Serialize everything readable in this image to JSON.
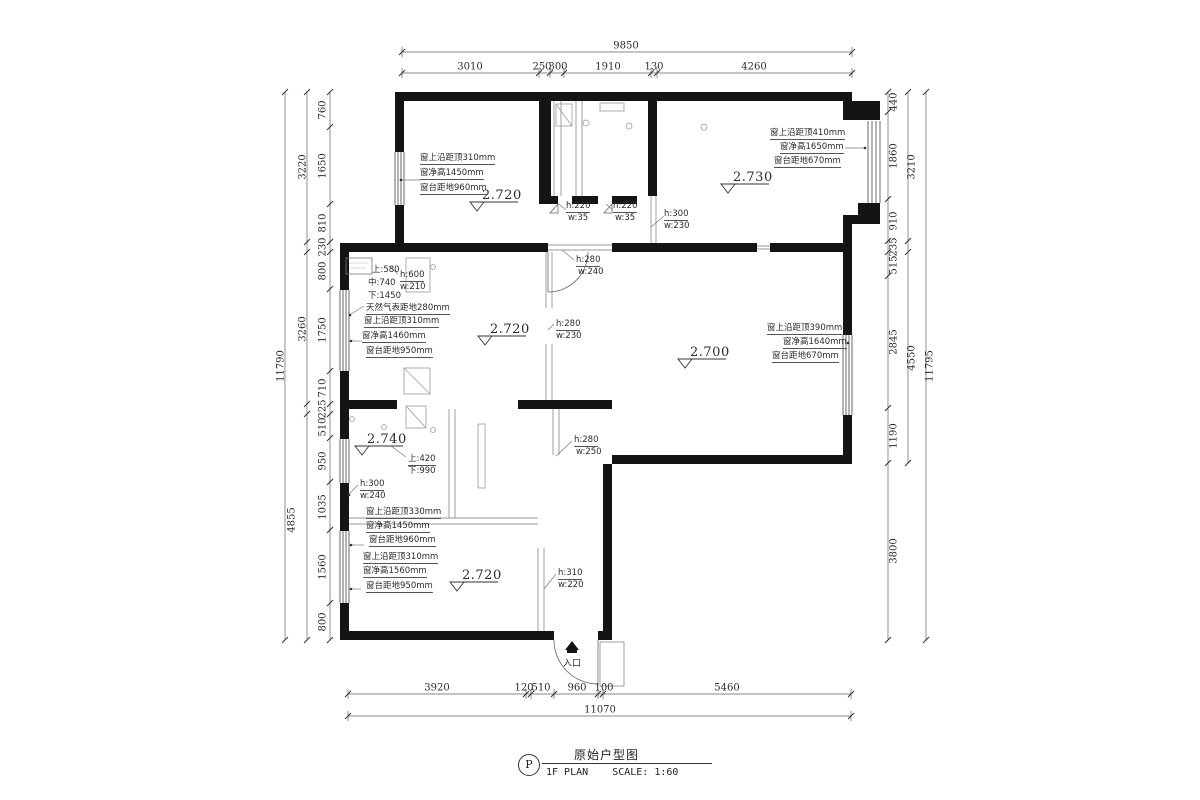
{
  "drawing": {
    "marker": "P",
    "title": "原始户型图",
    "plan_label": "1F PLAN",
    "scale_label": "SCALE: 1:60"
  },
  "labels": [
    {
      "t": "9850",
      "x": 626,
      "y": 46,
      "c": "dt"
    },
    {
      "t": "3010",
      "x": 470,
      "y": 67,
      "c": "dt"
    },
    {
      "t": "250",
      "x": 542,
      "y": 67,
      "c": "dt"
    },
    {
      "t": "300",
      "x": 558,
      "y": 67,
      "c": "dt"
    },
    {
      "t": "1910",
      "x": 608,
      "y": 67,
      "c": "dt"
    },
    {
      "t": "130",
      "x": 654,
      "y": 67,
      "c": "dt"
    },
    {
      "t": "4260",
      "x": 754,
      "y": 67,
      "c": "dt"
    },
    {
      "t": "3920",
      "x": 437,
      "y": 688,
      "c": "dt"
    },
    {
      "t": "120",
      "x": 524,
      "y": 688,
      "c": "dt"
    },
    {
      "t": "510",
      "x": 541,
      "y": 688,
      "c": "dt"
    },
    {
      "t": "960",
      "x": 577,
      "y": 688,
      "c": "dt"
    },
    {
      "t": "100",
      "x": 604,
      "y": 688,
      "c": "dt"
    },
    {
      "t": "5460",
      "x": 727,
      "y": 688,
      "c": "dt"
    },
    {
      "t": "11070",
      "x": 600,
      "y": 710,
      "c": "dt"
    },
    {
      "t": "760",
      "x": 323,
      "y": 110,
      "c": "dv"
    },
    {
      "t": "1650",
      "x": 323,
      "y": 166,
      "c": "dv"
    },
    {
      "t": "810",
      "x": 323,
      "y": 223,
      "c": "dv"
    },
    {
      "t": "230",
      "x": 323,
      "y": 247,
      "c": "dv"
    },
    {
      "t": "800",
      "x": 323,
      "y": 271,
      "c": "dv"
    },
    {
      "t": "1750",
      "x": 323,
      "y": 330,
      "c": "dv"
    },
    {
      "t": "710",
      "x": 323,
      "y": 388,
      "c": "dv"
    },
    {
      "t": "225",
      "x": 323,
      "y": 409,
      "c": "dv"
    },
    {
      "t": "510",
      "x": 323,
      "y": 427,
      "c": "dv"
    },
    {
      "t": "950",
      "x": 323,
      "y": 461,
      "c": "dv"
    },
    {
      "t": "1035",
      "x": 323,
      "y": 507,
      "c": "dv"
    },
    {
      "t": "1560",
      "x": 323,
      "y": 567,
      "c": "dv"
    },
    {
      "t": "800",
      "x": 323,
      "y": 622,
      "c": "dv"
    },
    {
      "t": "3220",
      "x": 303,
      "y": 167,
      "c": "dv"
    },
    {
      "t": "3260",
      "x": 303,
      "y": 329,
      "c": "dv"
    },
    {
      "t": "4855",
      "x": 292,
      "y": 520,
      "c": "dv"
    },
    {
      "t": "11790",
      "x": 281,
      "y": 366,
      "c": "dv"
    },
    {
      "t": "440",
      "x": 894,
      "y": 102,
      "c": "dv"
    },
    {
      "t": "1860",
      "x": 894,
      "y": 156,
      "c": "dv"
    },
    {
      "t": "910",
      "x": 894,
      "y": 221,
      "c": "dv"
    },
    {
      "t": "235",
      "x": 894,
      "y": 247,
      "c": "dv"
    },
    {
      "t": "515",
      "x": 894,
      "y": 265,
      "c": "dv"
    },
    {
      "t": "2845",
      "x": 894,
      "y": 342,
      "c": "dv"
    },
    {
      "t": "1190",
      "x": 894,
      "y": 436,
      "c": "dv"
    },
    {
      "t": "3800",
      "x": 894,
      "y": 551,
      "c": "dv"
    },
    {
      "t": "3210",
      "x": 912,
      "y": 167,
      "c": "dv"
    },
    {
      "t": "4550",
      "x": 912,
      "y": 358,
      "c": "dv"
    },
    {
      "t": "11795",
      "x": 930,
      "y": 366,
      "c": "dv"
    },
    {
      "t": "2.720",
      "x": 482,
      "y": 188,
      "c": "lv"
    },
    {
      "t": "2.730",
      "x": 733,
      "y": 170,
      "c": "lv"
    },
    {
      "t": "2.720",
      "x": 490,
      "y": 322,
      "c": "lv"
    },
    {
      "t": "2.700",
      "x": 690,
      "y": 345,
      "c": "lv"
    },
    {
      "t": "2.740",
      "x": 367,
      "y": 432,
      "c": "lv"
    },
    {
      "t": "2.720",
      "x": 462,
      "y": 568,
      "c": "lv"
    },
    {
      "t": "窗上沿距顶310mm",
      "x": 420,
      "y": 151,
      "c": "an"
    },
    {
      "t": "窗净高1450mm",
      "x": 420,
      "y": 166,
      "c": "an"
    },
    {
      "t": "窗台距地960mm",
      "x": 420,
      "y": 181,
      "c": "an"
    },
    {
      "t": "窗上沿距顶410mm",
      "x": 770,
      "y": 126,
      "c": "an"
    },
    {
      "t": "窗净高1650mm",
      "x": 780,
      "y": 140,
      "c": "an"
    },
    {
      "t": "窗台距地670mm",
      "x": 774,
      "y": 154,
      "c": "an"
    },
    {
      "t": "h:220",
      "x": 566,
      "y": 201,
      "c": "an"
    },
    {
      "t": "w:35",
      "x": 568,
      "y": 213,
      "c": "ap"
    },
    {
      "t": "h:220",
      "x": 613,
      "y": 201,
      "c": "an"
    },
    {
      "t": "w:35",
      "x": 615,
      "y": 213,
      "c": "ap"
    },
    {
      "t": "h:300",
      "x": 664,
      "y": 209,
      "c": "an"
    },
    {
      "t": "w:230",
      "x": 664,
      "y": 221,
      "c": "ap"
    },
    {
      "t": "h:280",
      "x": 576,
      "y": 255,
      "c": "an"
    },
    {
      "t": "w:240",
      "x": 578,
      "y": 267,
      "c": "ap"
    },
    {
      "t": "上:580",
      "x": 372,
      "y": 263,
      "c": "ap"
    },
    {
      "t": "中:740",
      "x": 368,
      "y": 276,
      "c": "ap"
    },
    {
      "t": "下:1450",
      "x": 368,
      "y": 289,
      "c": "ap"
    },
    {
      "t": "h:600",
      "x": 400,
      "y": 270,
      "c": "an"
    },
    {
      "t": "w:210",
      "x": 400,
      "y": 282,
      "c": "ap"
    },
    {
      "t": "天然气表距地280mm",
      "x": 366,
      "y": 301,
      "c": "an"
    },
    {
      "t": "窗上沿距顶310mm",
      "x": 364,
      "y": 314,
      "c": "an"
    },
    {
      "t": "窗净高1460mm",
      "x": 362,
      "y": 329,
      "c": "an"
    },
    {
      "t": "窗台距地950mm",
      "x": 366,
      "y": 344,
      "c": "an"
    },
    {
      "t": "h:280",
      "x": 556,
      "y": 319,
      "c": "an"
    },
    {
      "t": "w:230",
      "x": 556,
      "y": 331,
      "c": "ap"
    },
    {
      "t": "窗上沿距顶390mm",
      "x": 767,
      "y": 321,
      "c": "an"
    },
    {
      "t": "窗净高1640mm",
      "x": 783,
      "y": 335,
      "c": "an"
    },
    {
      "t": "窗台距地670mm",
      "x": 772,
      "y": 349,
      "c": "an"
    },
    {
      "t": "h:280",
      "x": 574,
      "y": 435,
      "c": "an"
    },
    {
      "t": "w:250",
      "x": 576,
      "y": 447,
      "c": "ap"
    },
    {
      "t": "上:420",
      "x": 408,
      "y": 452,
      "c": "an"
    },
    {
      "t": "下:990",
      "x": 408,
      "y": 464,
      "c": "ap"
    },
    {
      "t": "h:300",
      "x": 360,
      "y": 479,
      "c": "an"
    },
    {
      "t": "w:240",
      "x": 360,
      "y": 491,
      "c": "ap"
    },
    {
      "t": "窗上沿距顶330mm",
      "x": 366,
      "y": 505,
      "c": "an"
    },
    {
      "t": "窗净高1450mm",
      "x": 366,
      "y": 519,
      "c": "an"
    },
    {
      "t": "窗台距地960mm",
      "x": 369,
      "y": 533,
      "c": "an"
    },
    {
      "t": "窗上沿距顶310mm",
      "x": 363,
      "y": 550,
      "c": "an"
    },
    {
      "t": "窗净高1560mm",
      "x": 363,
      "y": 564,
      "c": "an"
    },
    {
      "t": "窗台距地950mm",
      "x": 366,
      "y": 579,
      "c": "an"
    },
    {
      "t": "h:310",
      "x": 558,
      "y": 568,
      "c": "an"
    },
    {
      "t": "w:220",
      "x": 558,
      "y": 580,
      "c": "ap"
    },
    {
      "t": "入口",
      "x": 563,
      "y": 656,
      "c": "en"
    }
  ]
}
